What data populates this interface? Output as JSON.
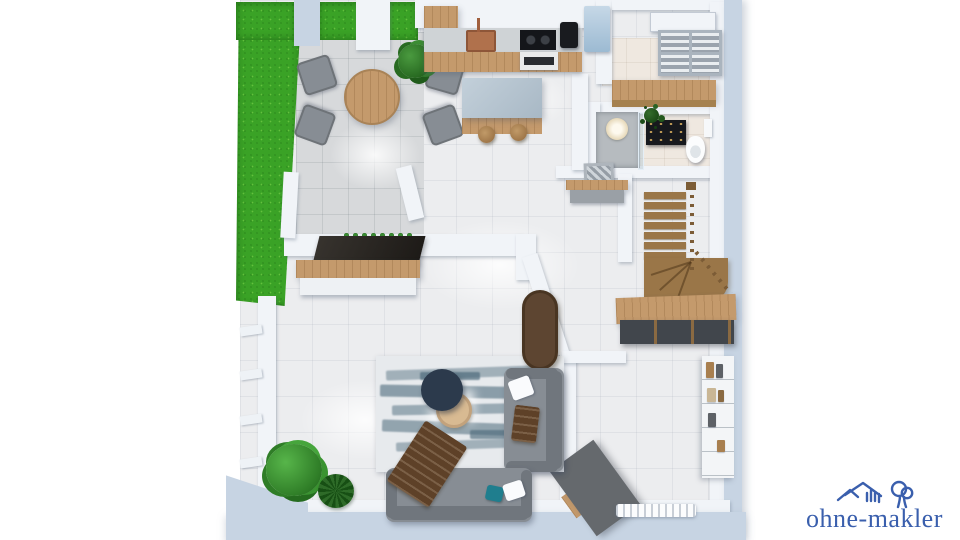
{
  "meta": {
    "title": "3D floor plan rendering, ground floor, top-down isometric view",
    "background": "#ffffff"
  },
  "branding": {
    "logo_text": "ohne-makler",
    "logo_color": "#3a5fad",
    "logo_icons": [
      "house-icon",
      "tree-icon"
    ]
  },
  "palette": {
    "wall": "#c7d4e3",
    "wall_white": "#f1f4f8",
    "floor": "#ecedef",
    "terrace": "#d7d9db",
    "grass": "#3aa226",
    "wood": "#c49a6c",
    "wood_dark": "#a5814f",
    "wood_stair": "#9a7648",
    "island_top": "#b5c3cf",
    "sofa": "#878d94",
    "sofa_dark": "#70767d",
    "rug_base": "#e7eaed",
    "rug_accent": "#4e6b7c",
    "navy": "#2c3a4c",
    "beige": "#d8ba92",
    "black": "#17191d",
    "fridge": "#aecae0",
    "plant": "#3f9a35",
    "plant_dark": "#2e6b28",
    "desk": "#65696d",
    "throw": "#5e4128",
    "teal": "#1f7e8e",
    "logo_blue": "#3a5fad"
  },
  "rooms": [
    {
      "name": "garden-terrace",
      "items": [
        "lawn",
        "patio-tiles",
        "round-dining-table",
        "four-dining-chairs",
        "potted-plant"
      ]
    },
    {
      "name": "kitchen",
      "items": [
        "tall-cabinet",
        "counter-with-sink",
        "copper-faucet",
        "cooktop",
        "oven",
        "coffee-machine",
        "fridge",
        "kitchen-island",
        "two-bar-stools"
      ]
    },
    {
      "name": "utility-room",
      "items": [
        "wall-cabinet",
        "open-wardrobe-shelf"
      ]
    },
    {
      "name": "bathroom",
      "items": [
        "glass-shower",
        "round-shower-tray",
        "black-vanity-sink",
        "toilet",
        "towel",
        "small-plant"
      ]
    },
    {
      "name": "hallway",
      "items": [
        "sideboard",
        "picture-frame"
      ]
    },
    {
      "name": "staircase",
      "items": [
        "wooden-winder-stairs",
        "railing-with-balusters",
        "under-stair-sideboard"
      ]
    },
    {
      "name": "living-room",
      "items": [
        "abstract-area-rug",
        "two-grey-sofas",
        "navy-round-coffee-table",
        "beige-round-side-table",
        "tv-sideboard",
        "flatscreen-tv",
        "oval-console",
        "throw-blankets",
        "pillows",
        "two-potted-plants",
        "wall-planter"
      ]
    },
    {
      "name": "study",
      "items": [
        "diagonal-desk",
        "white-bookshelf",
        "radiator",
        "window-wall"
      ]
    }
  ]
}
